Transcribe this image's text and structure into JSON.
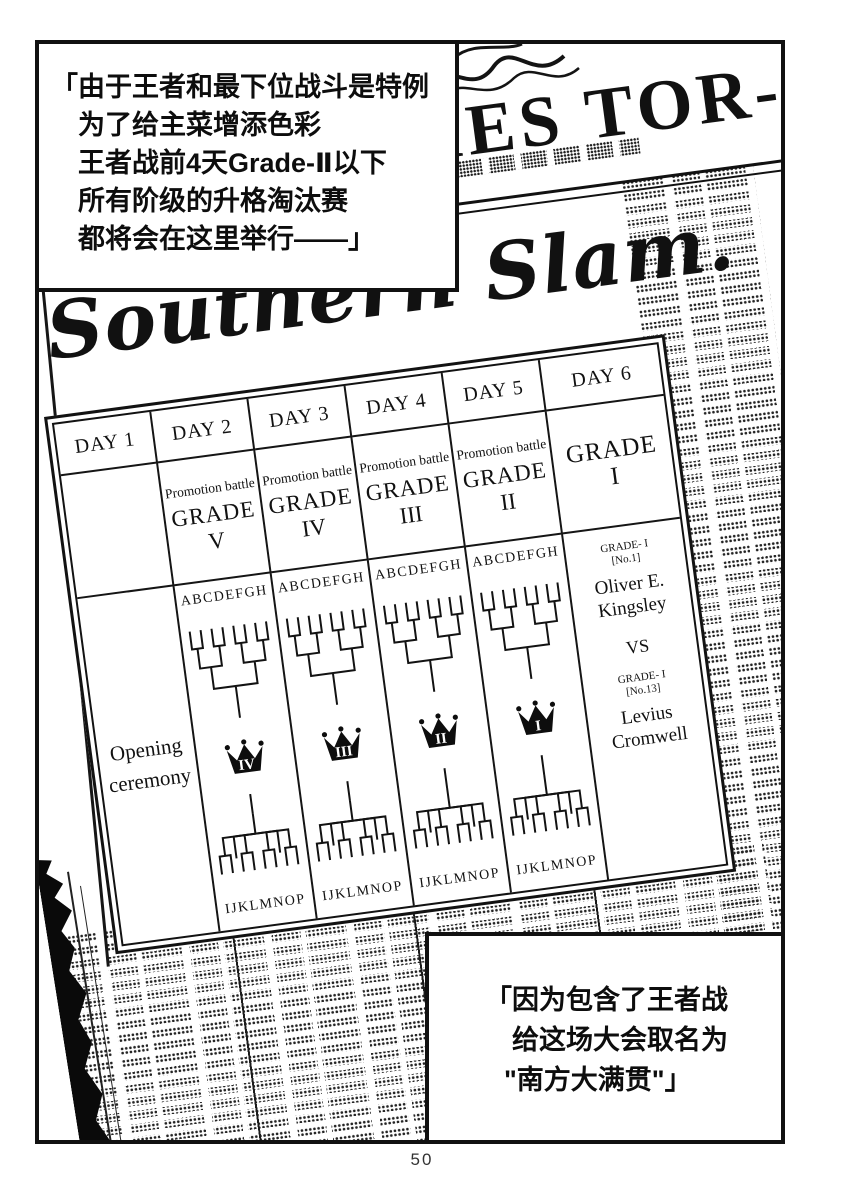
{
  "page": {
    "number": "50"
  },
  "dialogue_top": {
    "l1": "「由于王者和最下位战斗是特例",
    "l2": "为了给主菜增添色彩",
    "l3": "王者战前4天Grade-Ⅱ以下",
    "l4": "所有阶级的升格淘汰赛",
    "l5": "都将会在这里举行——」"
  },
  "dialogue_bottom": {
    "l1": "「因为包含了王者战",
    "l2": "给这场大会取名为",
    "l3": "\"南方大满贯\"」"
  },
  "newspaper": {
    "masthead_fragment": "MES TOR-CAN",
    "headline": "Southern Slam.",
    "schedule": {
      "day1": {
        "label": "DAY 1",
        "event_line1": "Opening",
        "event_line2": "ceremony"
      },
      "day2": {
        "label": "DAY 2",
        "battle": "Promotion battle",
        "grade": "GRADE",
        "numeral": "V",
        "bracket_top": "ABCDEFGH",
        "crown": "IV",
        "bracket_bottom": "IJKLMNOP"
      },
      "day3": {
        "label": "DAY 3",
        "battle": "Promotion battle",
        "grade": "GRADE",
        "numeral": "IV",
        "bracket_top": "ABCDEFGH",
        "crown": "III",
        "bracket_bottom": "IJKLMNOP"
      },
      "day4": {
        "label": "DAY 4",
        "battle": "Promotion battle",
        "grade": "GRADE",
        "numeral": "III",
        "bracket_top": "ABCDEFGH",
        "crown": "II",
        "bracket_bottom": "IJKLMNOP"
      },
      "day5": {
        "label": "DAY 5",
        "battle": "Promotion battle",
        "grade": "GRADE",
        "numeral": "II",
        "bracket_top": "ABCDEFGH",
        "crown": "I",
        "bracket_bottom": "IJKLMNOP"
      },
      "day6": {
        "label": "DAY 6",
        "grade": "GRADE",
        "numeral": "I",
        "fighter1_grade": "GRADE- I",
        "fighter1_rank": "[No.1]",
        "fighter1_name1": "Oliver E.",
        "fighter1_name2": "Kingsley",
        "vs": "VS",
        "fighter2_grade": "GRADE- I",
        "fighter2_rank": "[No.13]",
        "fighter2_name1": "Levius",
        "fighter2_name2": "Cromwell"
      }
    }
  }
}
